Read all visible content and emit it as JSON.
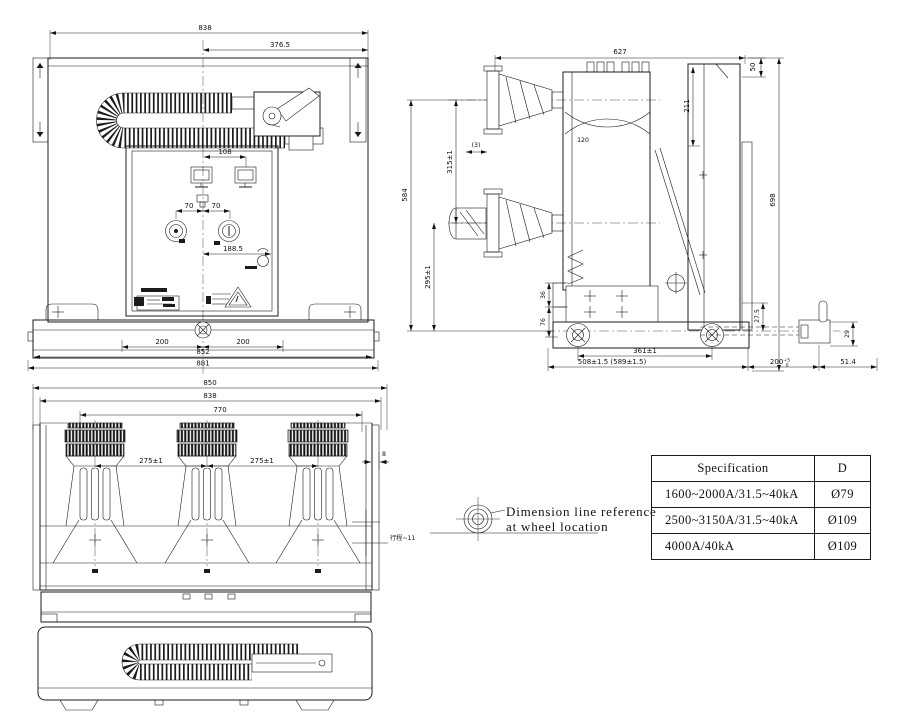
{
  "colors": {
    "background": "#ffffff",
    "line": "#1c1c1c"
  },
  "top_view": {
    "d838": "838",
    "d3765": "376.5",
    "d108": "108",
    "d70a": "70",
    "d70b": "70",
    "d1885": "188.5",
    "d200a": "200",
    "d200b": "200",
    "d852": "852",
    "d881": "881"
  },
  "side_view": {
    "d627": "627",
    "d50": "50",
    "d698": "698",
    "d211": "211",
    "d120": "120",
    "d3": "(3)",
    "d315": "315±1",
    "d584": "584",
    "d295": "295±1",
    "d36": "36",
    "d76": "76",
    "d361": "361±1",
    "d508": "508±1.5 (589±1.5)",
    "d275": "27.5",
    "d200": "200",
    "d200sup": "+5",
    "d200sub": "0",
    "d514": "51.4",
    "d29": "29"
  },
  "front_view": {
    "d850": "850",
    "d838": "838",
    "d770": "770",
    "d275a": "275±1",
    "d275b": "275±1",
    "d8": "8",
    "stroke_label": "行程~11"
  },
  "note": {
    "line1": "Dimension line reference",
    "line2": "at wheel location"
  },
  "spec_table": {
    "header_spec": "Specification",
    "header_d": "D",
    "rows": [
      {
        "spec": "1600~2000A/31.5~40kA",
        "d": "Ø79"
      },
      {
        "spec": "2500~3150A/31.5~40kA",
        "d": "Ø109"
      },
      {
        "spec": "4000A/40kA",
        "d": "Ø109"
      }
    ]
  }
}
